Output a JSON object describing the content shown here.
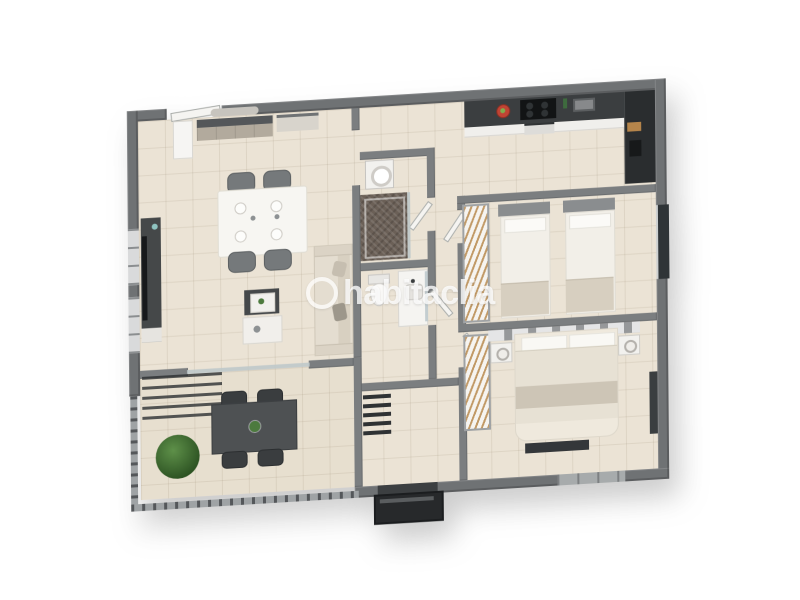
{
  "image": {
    "type": "3d-floor-plan-render",
    "description": "Isometric 3D rendered floor plan of a two-bedroom apartment with terrace, published on a real-estate portal",
    "background": "#ffffff"
  },
  "watermark": {
    "text": "habitaclia",
    "logo": "ring-icon",
    "color": "#ffffff",
    "opacity": 0.75
  },
  "palette": {
    "exterior_wall": "#6f7274",
    "interior_wall": "#7b7e80",
    "floor_tile": "#ebe3d5",
    "terrace_tile": "#e7dfcf",
    "kitchen_counter": "#3b3e40",
    "dark_furniture": "#45484a",
    "white_furniture": "#f4f3f0",
    "textile_beige": "#e7e1d4",
    "textile_gray": "#cdc5b6",
    "hanger_wood": "#be945e",
    "plant_green": "#4c7a3e",
    "shower_tile": "#6b6057",
    "glass": "#bcc7c9"
  },
  "rooms": [
    {
      "name": "living-dining",
      "furniture": [
        "sideboard with mirror",
        "tall white cabinet",
        "dining table set for four",
        "4 upholstered chairs",
        "TV media unit with television",
        "three-seat sofa with cushions",
        "nesting coffee tables with decor"
      ]
    },
    {
      "name": "terrace",
      "furniture": [
        "outdoor dining table",
        "4 outdoor chairs",
        "large potted plant",
        "glass slider to living room",
        "perimeter railing",
        "pergola slats"
      ]
    },
    {
      "name": "kitchen",
      "furniture": [
        "dark countertop",
        "white cabinet fronts",
        "cooktop with 4 burners",
        "oven",
        "microwave",
        "tall fridge unit",
        "fruit plate",
        "green bottle",
        "cutting board"
      ]
    },
    {
      "name": "utility-shower-room",
      "furniture": [
        "washing machine",
        "walk-in shower with dark feature tile and glass screen"
      ]
    },
    {
      "name": "bathroom",
      "furniture": [
        "toilet",
        "vanity with basin and faucet",
        "wall mirror"
      ]
    },
    {
      "name": "hallway",
      "furniture": [
        "doors to bathrooms and bedrooms"
      ]
    },
    {
      "name": "twin-bedroom",
      "furniture": [
        "two single beds with gray headboards",
        "open wardrobe with hangers",
        "window"
      ]
    },
    {
      "name": "master-bedroom",
      "furniture": [
        "double bed with pillows and throw",
        "headboard feature wall",
        "two nightstands with lamps",
        "open wardrobe with hangers",
        "foot-of-bed bench",
        "radiator",
        "window"
      ]
    },
    {
      "name": "entry",
      "furniture": [
        "entrance door vestibule",
        "slatted shoe rack"
      ]
    }
  ]
}
